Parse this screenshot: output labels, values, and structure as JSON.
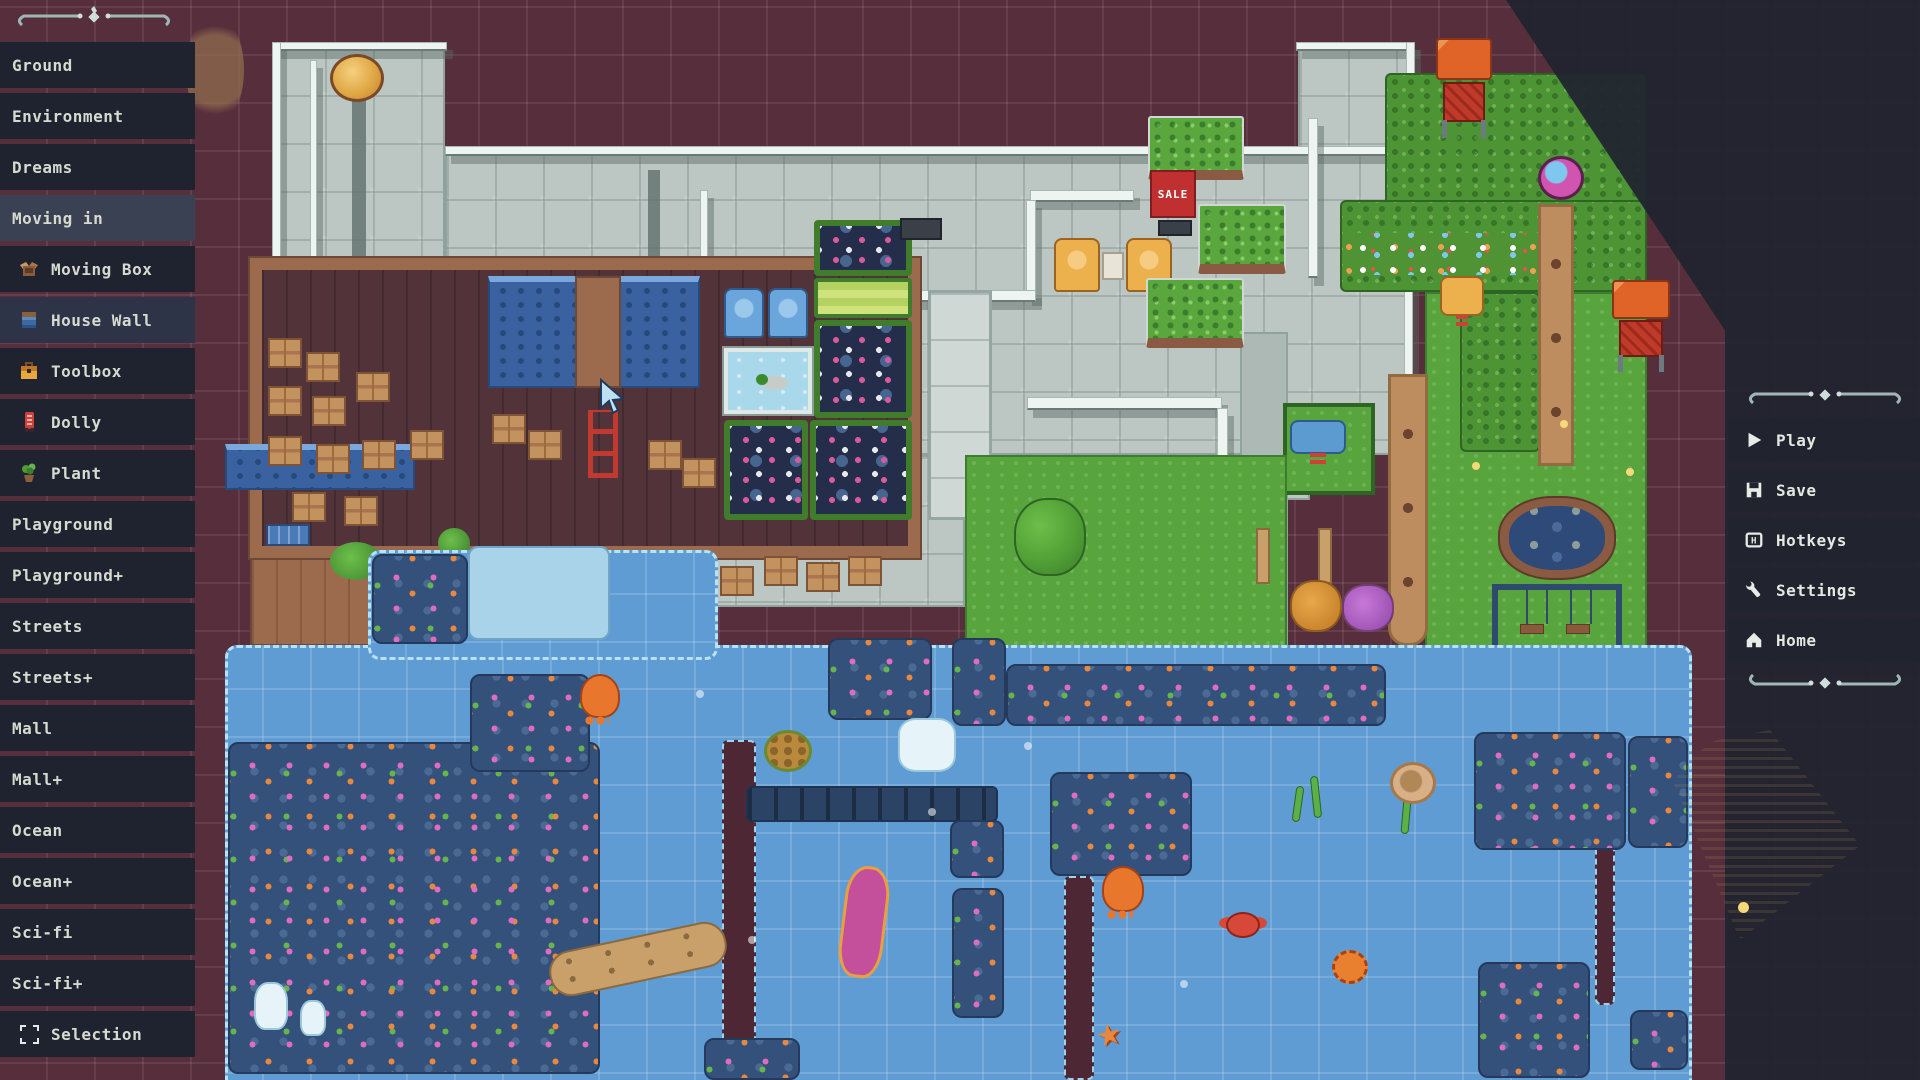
{
  "editor": {
    "sale_sign_text": "SALE"
  },
  "left_sidebar": {
    "items": [
      {
        "label": "Ground",
        "type": "category",
        "selected": false
      },
      {
        "label": "Environment",
        "type": "category",
        "selected": false
      },
      {
        "label": "Dreams",
        "type": "category",
        "selected": false
      },
      {
        "label": "Moving in",
        "type": "category",
        "selected": true
      },
      {
        "label": "Moving Box",
        "type": "item",
        "icon": "moving-box-icon",
        "selected": false
      },
      {
        "label": "House Wall",
        "type": "item",
        "icon": "house-wall-icon",
        "selected": true
      },
      {
        "label": "Toolbox",
        "type": "item",
        "icon": "toolbox-icon",
        "selected": false
      },
      {
        "label": "Dolly",
        "type": "item",
        "icon": "dolly-icon",
        "selected": false
      },
      {
        "label": "Plant",
        "type": "item",
        "icon": "plant-icon",
        "selected": false
      },
      {
        "label": "Playground",
        "type": "category",
        "selected": false
      },
      {
        "label": "Playground+",
        "type": "category",
        "selected": false
      },
      {
        "label": "Streets",
        "type": "category",
        "selected": false
      },
      {
        "label": "Streets+",
        "type": "category",
        "selected": false
      },
      {
        "label": "Mall",
        "type": "category",
        "selected": false
      },
      {
        "label": "Mall+",
        "type": "category",
        "selected": false
      },
      {
        "label": "Ocean",
        "type": "category",
        "selected": false
      },
      {
        "label": "Ocean+",
        "type": "category",
        "selected": false
      },
      {
        "label": "Sci-fi",
        "type": "category",
        "selected": false
      },
      {
        "label": "Sci-fi+",
        "type": "category",
        "selected": false
      },
      {
        "label": "Selection",
        "type": "item",
        "icon": "selection-icon",
        "selected": false
      }
    ]
  },
  "right_sidebar": {
    "buttons": [
      {
        "label": "Play",
        "icon": "play-icon"
      },
      {
        "label": "Save",
        "icon": "save-icon"
      },
      {
        "label": "Hotkeys",
        "icon": "hotkeys-icon"
      },
      {
        "label": "Settings",
        "icon": "settings-icon"
      },
      {
        "label": "Home",
        "icon": "home-icon"
      }
    ]
  },
  "map": {
    "props": [
      "coin-plaque",
      "mall-floor",
      "white-railings",
      "moving-room",
      "moving-boxes",
      "dolly",
      "pool-strips",
      "bench",
      "potted-plant",
      "dock-bush",
      "aquarium-duck",
      "blue-armchairs",
      "vending-shelves",
      "checkout-counter",
      "display-case",
      "yellow-armchairs",
      "side-table",
      "sale-sign",
      "bush-planters",
      "tree",
      "hedges",
      "flower-bed",
      "beach-ball",
      "shrine-stands",
      "duck-spring-rider",
      "truck-spring-rider",
      "dirt-paths",
      "pond",
      "swing-set",
      "orange-bush",
      "purple-bush",
      "fence-posts",
      "ocean-water",
      "coral-reefs",
      "sea-turtle",
      "octopuses",
      "crab",
      "pufferfish",
      "starfish",
      "sunken-boat",
      "driftwood",
      "icebergs",
      "kelp",
      "sea-shell",
      "trenches",
      "sunken-pier",
      "mouse-cursor"
    ],
    "palette": {
      "background": "#572e3c",
      "floor": "#bcc6c2",
      "water": "#5f9cd4",
      "grass": "#58a53d",
      "hedge": "#4c9434",
      "wood": "#9c6b4e",
      "reef": "#34517c",
      "panel": "#21242f",
      "accent_red": "#c03030"
    }
  }
}
